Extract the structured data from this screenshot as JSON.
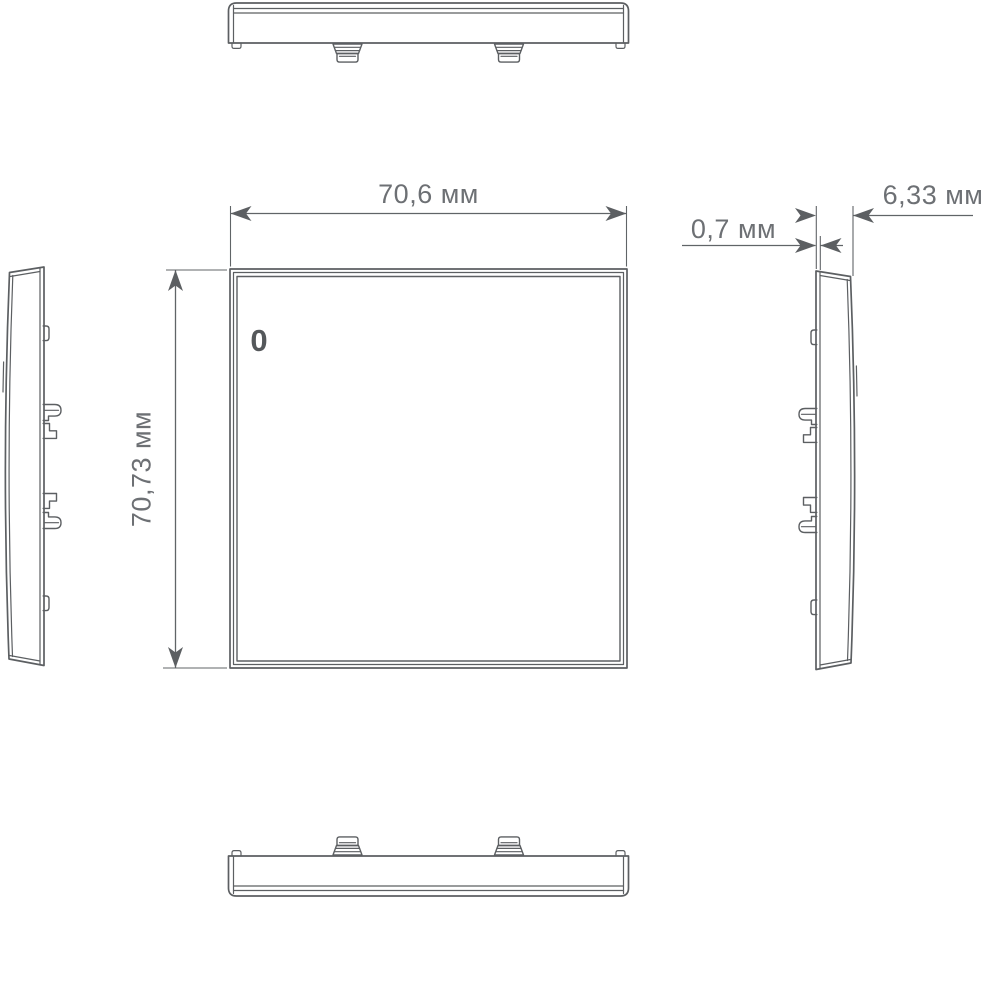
{
  "colors": {
    "background": "#ffffff",
    "line": "#5c5f62",
    "dimension_text": "#6d7074"
  },
  "labels": {
    "width": "70,6 мм",
    "height": "70,73 мм",
    "thickness": "0,7 мм",
    "depth": "6,33 мм",
    "indicator": "0"
  }
}
